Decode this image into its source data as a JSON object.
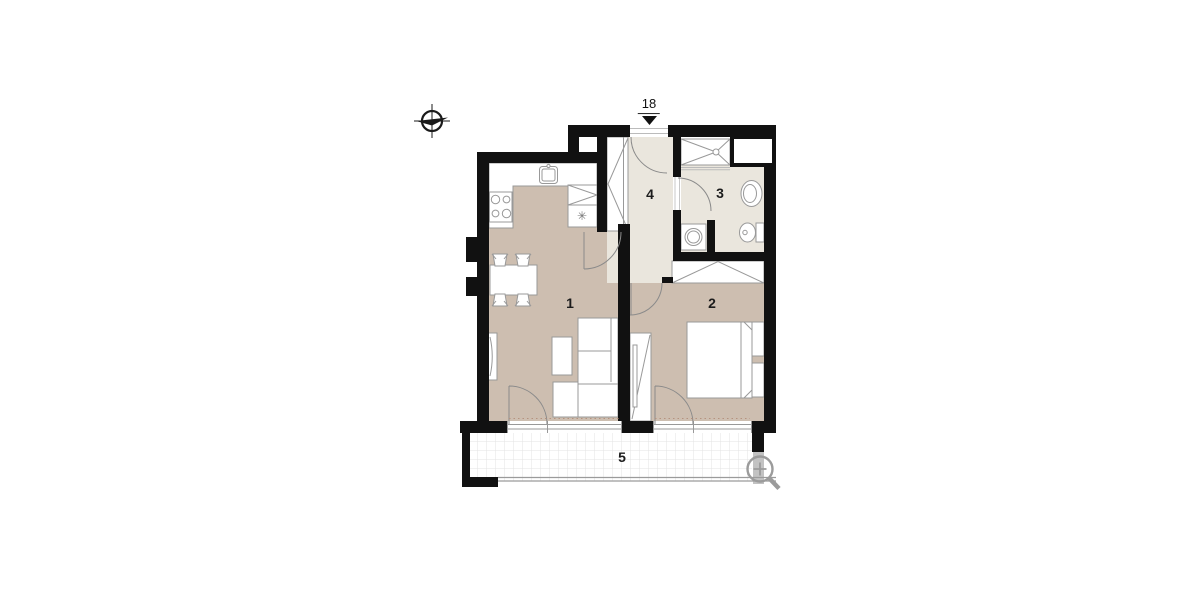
{
  "unit": {
    "number": "18"
  },
  "rooms": [
    {
      "label": "1"
    },
    {
      "label": "2"
    },
    {
      "label": "3"
    },
    {
      "label": "4"
    },
    {
      "label": "5"
    }
  ],
  "symbols": {
    "freezer": "✳"
  },
  "icons": {
    "compass": "compass-icon",
    "magnifier": "zoom-in-icon",
    "entrance_arrow": "entrance-arrow-icon"
  },
  "colors": {
    "wall": "#111111",
    "floor_main": "#cdbeb0",
    "floor_service": "#eae6dd",
    "furniture_stroke": "#999999",
    "door_stroke": "#8a8a8a",
    "frame_light": "#bbbbbb",
    "grid": "#e3e3e3",
    "icon_gray": "#9b9b9b",
    "balcony_wall_gray": "#c2c2c2",
    "threshold_dots": "#b5937f",
    "label_text": "#1c1c1c"
  }
}
